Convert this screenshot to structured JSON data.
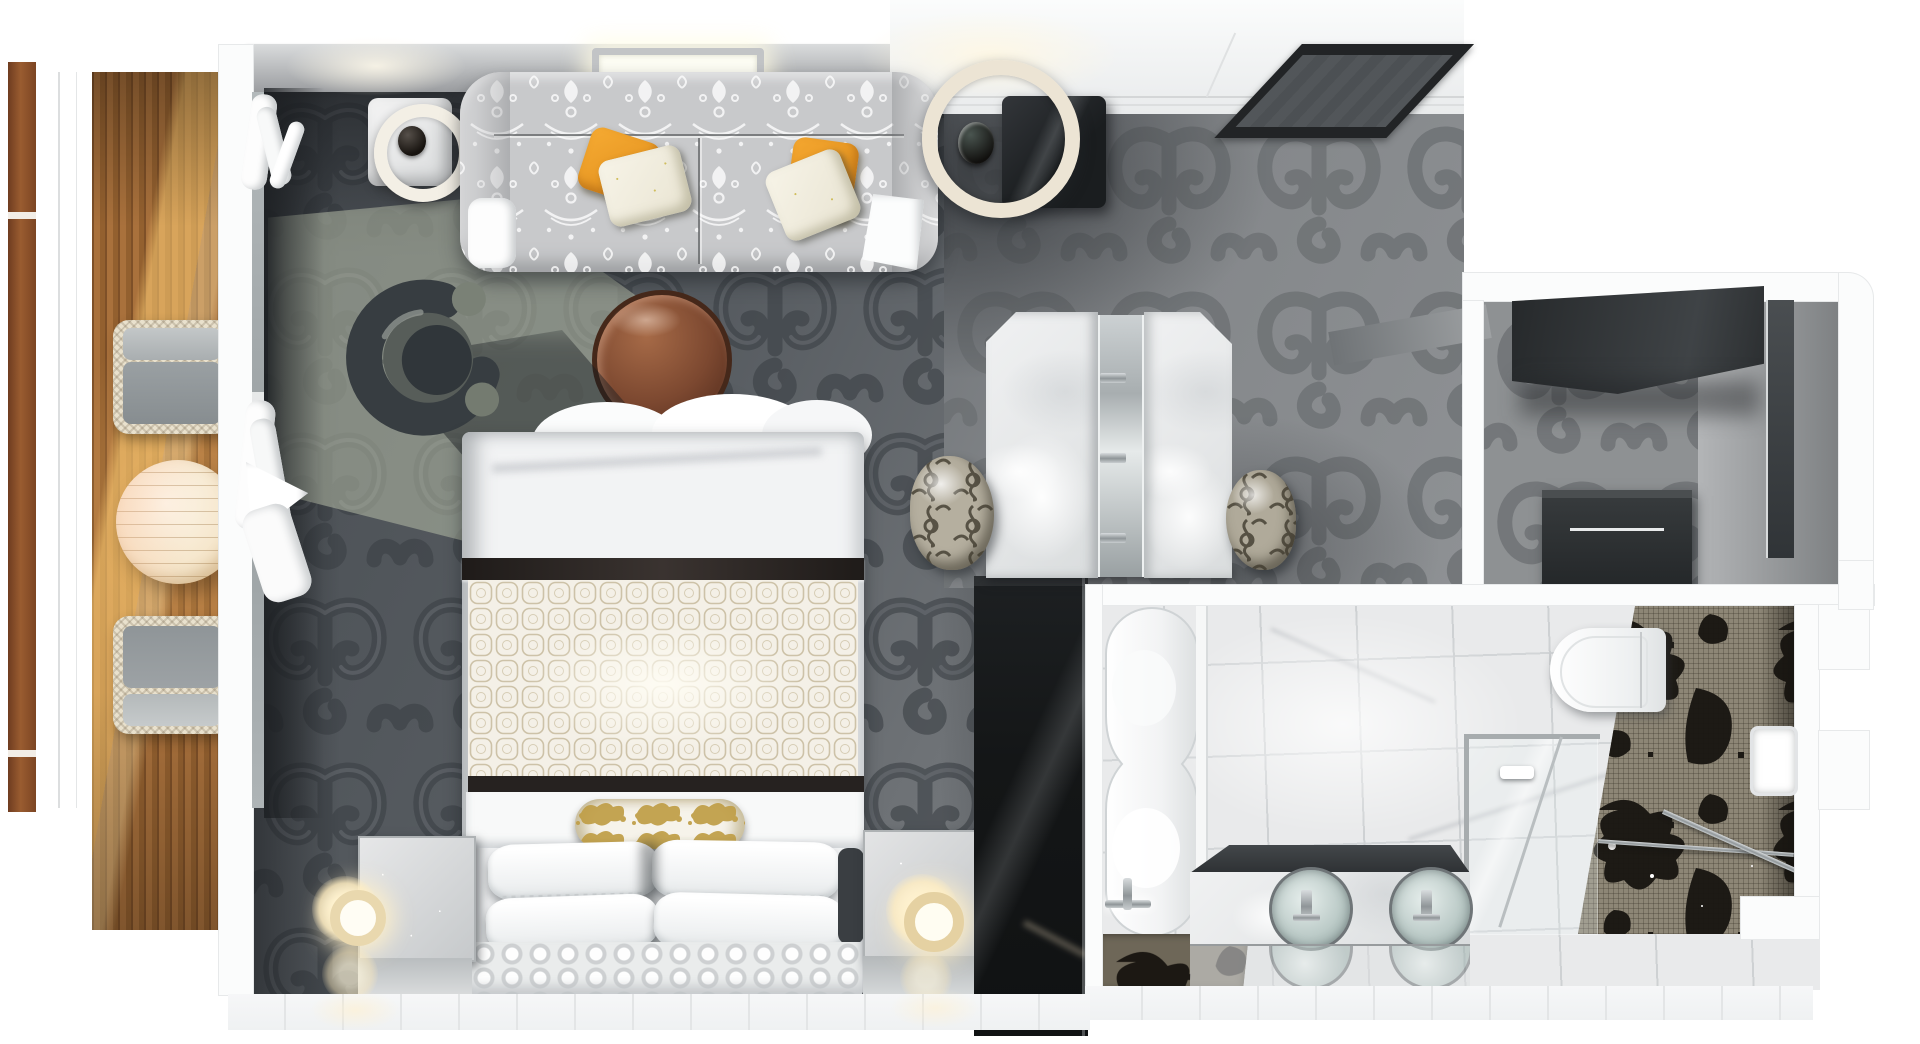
{
  "meta": {
    "title": "Suite floor plan - top-down 3D render",
    "render_style": "photoreal top-down 3D floor plan",
    "rooms_count": 4
  },
  "palette": {
    "background": "#ffffff",
    "wall_white": "#fbfcfc",
    "wall_grey_band": "#9b9da0",
    "carpet_dark": "#51565b",
    "carpet_scroll_dark": "#3a3e43",
    "carpet_light": "#85888b",
    "carpet_scroll_light": "#6b6e71",
    "sunlit_carpet": "#a8ae9e",
    "deck_wood": "#a9713c",
    "rail_wood": "#8a4f2a",
    "wicker_cream": "#e9e1cd",
    "cushion_grey": "#9aa0a3",
    "sofa_grey": "#c8c9cb",
    "sofa_damask_white": "#f4f4f4",
    "pillow_orange": "#f0a12c",
    "pillow_floral": "#f3f0e2",
    "coffee_table_copper": "#8a5638",
    "armchair_dark": "#383e42",
    "bed_white": "#f2f3f4",
    "bed_band_espresso": "#241f1d",
    "quilt_lattice": "#cdc2a8",
    "bolster_gold": "#bf9d45",
    "lamp_glow": "#ffe9bd",
    "dresser_black": "#1b1d1f",
    "marble_white": "#eceded",
    "tile_floor": "#e9eaeb",
    "mosaic_base": "#8d8676",
    "mosaic_damask_black": "#17140f",
    "sink_glass": "#c7d3d1",
    "chrome": "#9aa0a2"
  },
  "rooms": {
    "balcony": {
      "label": "private balcony with teak deck",
      "furniture": [
        {
          "name": "wicker armchair",
          "count": 2,
          "cushion": "grey"
        },
        {
          "name": "round bistro table",
          "count": 1,
          "finish": "cream, sunlit"
        }
      ],
      "features": [
        "wood slat railing",
        "sliding glass door",
        "sheer curtains"
      ]
    },
    "living_bedroom": {
      "label": "living and sleeping area",
      "furniture": [
        {
          "name": "damask sofa",
          "pillows_orange": 2,
          "pillows_floral": 2
        },
        {
          "name": "ring table lamp on side table",
          "count": 1
        },
        {
          "name": "ring floor lamp with dark side table",
          "count": 1
        },
        {
          "name": "round copper coffee table",
          "count": 1
        },
        {
          "name": "swivel armchair",
          "count": 1
        },
        {
          "name": "king bed",
          "pillows": 4,
          "bolster": "gold damask",
          "runner_bands": 2
        },
        {
          "name": "nightstand with glowing lamp",
          "count": 2
        },
        {
          "name": "black dresser",
          "count": 1
        },
        {
          "name": "marble vanity desk with mirror",
          "stools": 2
        }
      ],
      "features": [
        "scroll pattern carpet",
        "recessed ceiling light",
        "ceiling vent hatch"
      ]
    },
    "walk_in_closet": {
      "label": "walk-in closet",
      "furniture": [
        {
          "name": "dark wardrobe cabinet",
          "count": 1
        },
        {
          "name": "drawer console",
          "count": 1
        },
        {
          "name": "mirror door panel",
          "count": 1
        }
      ]
    },
    "bathroom": {
      "label": "marble bathroom",
      "furniture": [
        {
          "name": "freestanding soaking tub with floor faucet",
          "count": 1
        },
        {
          "name": "double vanity with round glass vessel sinks",
          "sinks": 2
        },
        {
          "name": "wall-hung toilet",
          "count": 1
        },
        {
          "name": "glass shower enclosure",
          "count": 1
        },
        {
          "name": "damask mosaic accent wall",
          "count": 1
        },
        {
          "name": "patterned bath mat",
          "count": 1
        }
      ],
      "features": [
        "white marble floor tiles"
      ]
    }
  }
}
